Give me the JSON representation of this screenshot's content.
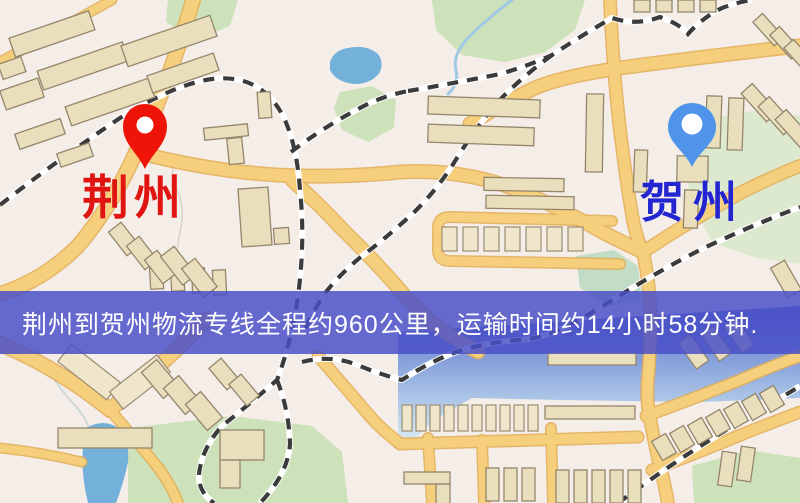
{
  "map": {
    "origin": {
      "label": "荆州"
    },
    "destination": {
      "label": "贺州"
    },
    "banner": {
      "text": "荆州到贺州物流专线全程约960公里，运输时间约14小时58分钟."
    },
    "route": {
      "distance": "约960公里",
      "duration": "约14小时58分钟"
    },
    "colors": {
      "origin_pin": "#ee1508",
      "origin_text": "#e01410",
      "destination_pin": "#4f94ea",
      "destination_text": "#2326d0",
      "banner_bg": "rgba(73,79,199,0.84)",
      "banner_text": "#ffffff",
      "background": "#f5ede8",
      "road": "#f6cf7c",
      "road_casing": "#e2ab52",
      "building": "#eadfbc",
      "building_outline": "#94866c",
      "park": "#cde2ba",
      "water": "#74b1da",
      "railway": "#3b3b3b"
    }
  }
}
